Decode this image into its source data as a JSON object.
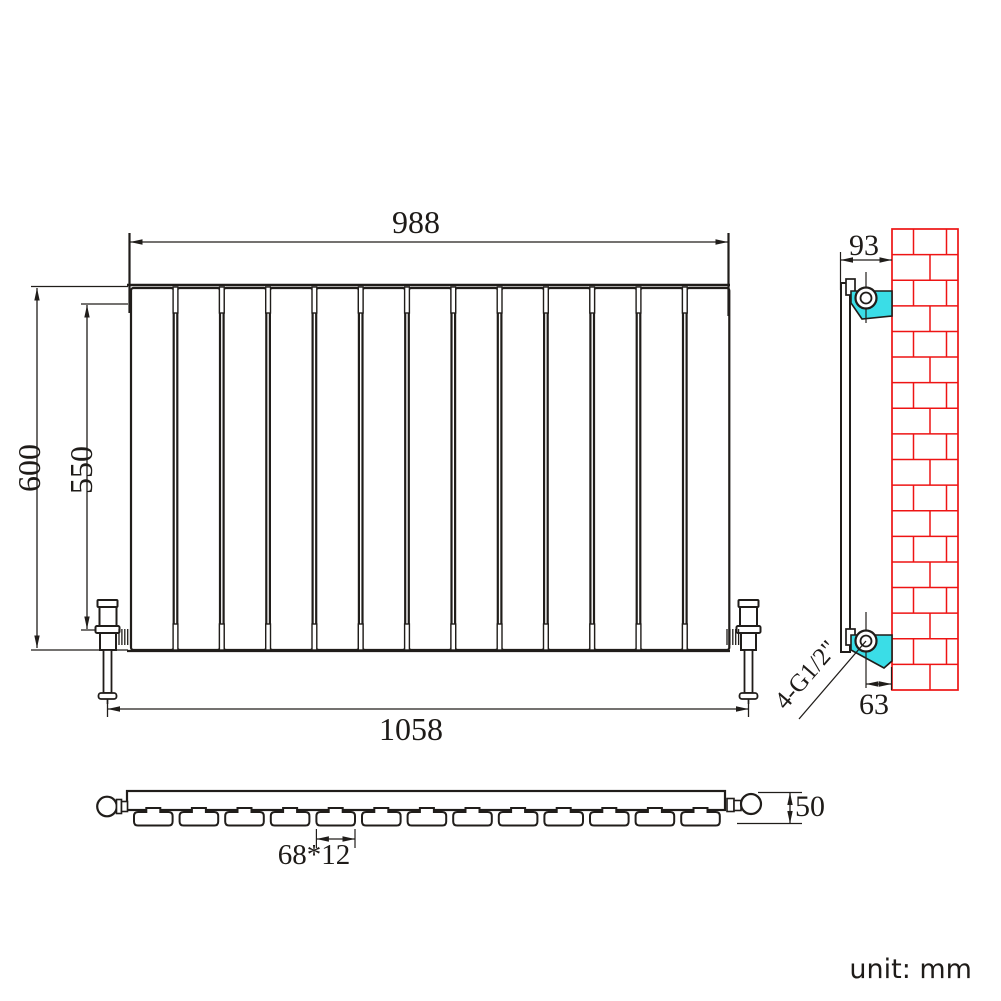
{
  "drawing": {
    "unit_label": "unit: mm",
    "front_view": {
      "panel_count": 13,
      "dim_top_width": "988",
      "dim_overall_height": "600",
      "dim_panel_height": "550",
      "dim_valve_span": "1058"
    },
    "side_view": {
      "dim_bracket_depth": "93",
      "dim_pipe_wall_offset": "63",
      "thread_label": "4-G1/2\""
    },
    "top_view": {
      "panel_count": 13,
      "dim_depth": "50",
      "dim_panel_section": "68*12"
    },
    "colors": {
      "line": "#201d1a",
      "brick_red": "#ee1414",
      "bracket_cyan": "#3adde7"
    }
  }
}
